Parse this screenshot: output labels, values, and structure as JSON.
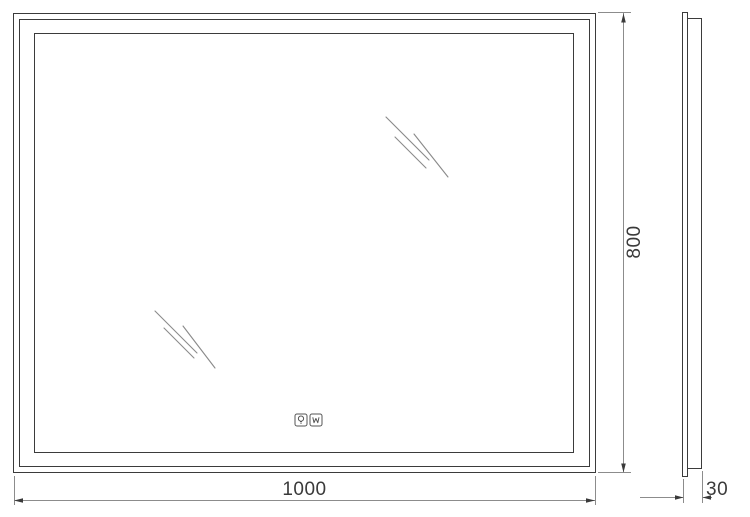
{
  "dimensions": {
    "width_mm": "1000",
    "height_mm": "800",
    "depth_mm": "30"
  },
  "icons": [
    {
      "name": "light-bulb-icon"
    },
    {
      "name": "anti-fog-icon"
    }
  ],
  "colors": {
    "outline": "#3b3b3b",
    "dimension_line": "#8c8c8c",
    "label_text": "#3a3a3a",
    "shine": "#8a8a8a"
  }
}
